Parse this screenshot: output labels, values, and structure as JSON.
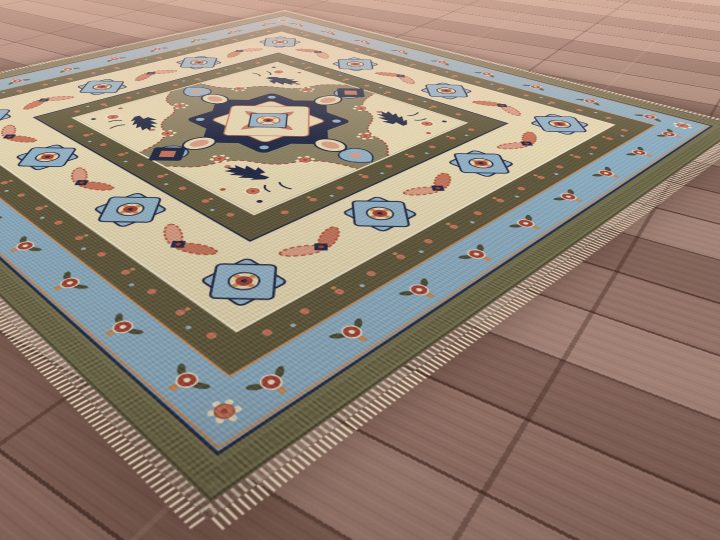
{
  "scene": {
    "type": "product-photo",
    "subject": "Hand-knotted Heriz Serapi style wool area rug with central geometric medallion, laid diagonally on a brown hardwood plank floor",
    "view": "low oblique angle, rug corner pointing toward viewer, far corner near top of frame",
    "visible_objects": [
      "wood plank floor",
      "area rug",
      "cream fringe on near edges",
      "central stepped medallion with pendants",
      "ivory main border with eight-point star medallions and coral serrated leaves",
      "light blue floral border",
      "olive green outer band",
      "dark brown guard bands with flower dots",
      "olive-taupe field with navy serrated leaves and blue palmettes",
      "cream corner spandrels"
    ]
  },
  "palette": {
    "floor-base": "#997a6e",
    "floor-light": "#c2a294",
    "floor-mid": "#8d6b60",
    "floor-dark": "#5e4239",
    "floor-seam": "#33201a",
    "haze": "#eec0ab",
    "fringe": "#e9dcc0",
    "olive-band": "#75714d",
    "blue-border": "#8db1c7",
    "brown-band": "#5d5639",
    "ivory": "#ebddb6",
    "cream": "#f2e8cc",
    "field": "#8b8162",
    "field-dark": "#6f684e",
    "navy": "#1c2441",
    "lblue": "#94b6cc",
    "coral": "#c97459",
    "salmon": "#de9e85",
    "red": "#a63d31",
    "rust": "#b25335",
    "orange": "#d18a4f",
    "gold": "#d8b765",
    "dkleaf": "#4b4a32"
  }
}
